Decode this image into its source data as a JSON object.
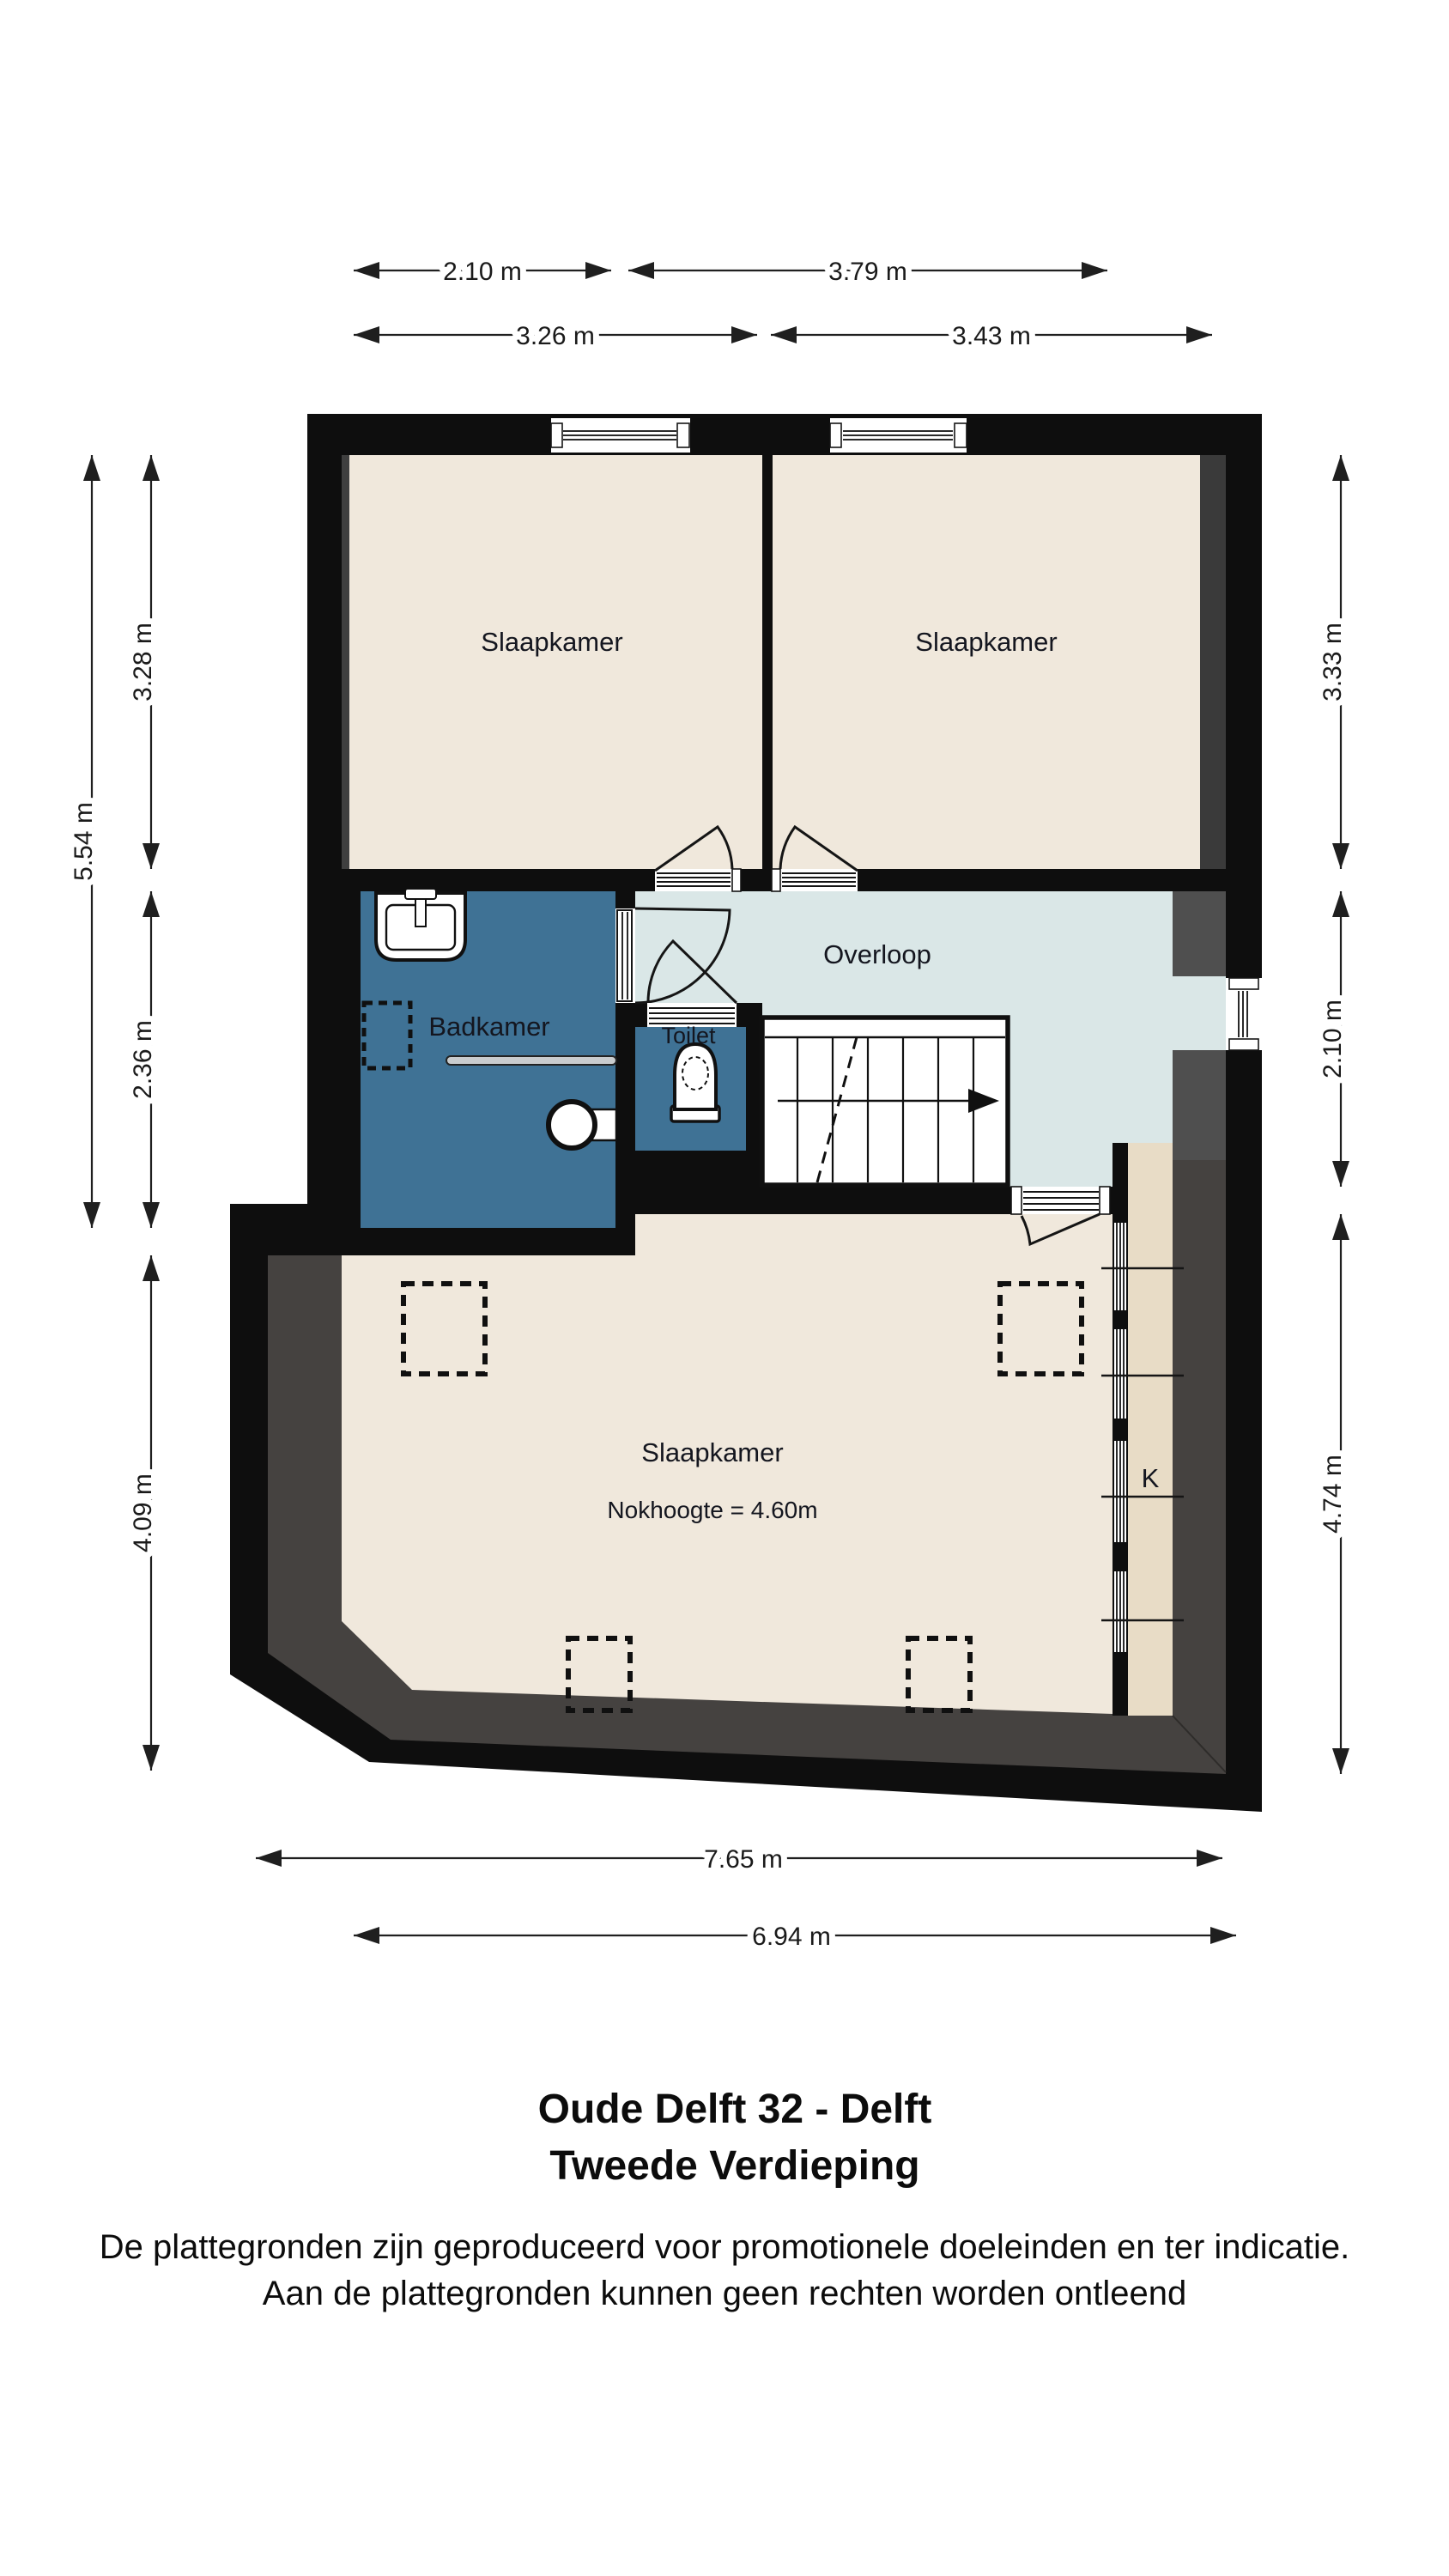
{
  "meta": {
    "document_type": "floor-plan",
    "language": "nl"
  },
  "rooms": {
    "bedroom_top_left": "Slaapkamer",
    "bedroom_top_right": "Slaapkamer",
    "landing": "Overloop",
    "bathroom": "Badkamer",
    "toilet": "Toilet",
    "attic_bedroom": "Slaapkamer",
    "attic_bedroom_note": "Nokhoogte = 4.60m",
    "closet": "K"
  },
  "dims": {
    "top_row1_left": "2.10 m",
    "top_row1_right": "3.79 m",
    "top_row2_left": "3.26 m",
    "top_row2_right": "3.43 m",
    "left_total": "5.54 m",
    "left_upper": "3.28 m",
    "left_middle": "2.36 m",
    "left_lower": "4.09 m",
    "right_upper": "3.33 m",
    "right_middle": "2.10 m",
    "right_lower": "4.74 m",
    "bottom_outer": "7.65 m",
    "bottom_inner": "6.94 m"
  },
  "footer": {
    "title_line1": "Oude Delft 32 - Delft",
    "title_line2": "Tweede Verdieping",
    "disclaimer_line1": "De plattegronden zijn geproduceerd voor promotionele doeleinden en ter indicatie.",
    "disclaimer_line2": "Aan de plattegronden kunnen geen rechten worden ontleend"
  },
  "colors": {
    "wall": "#0e0e0e",
    "floor_beige": "#f0e8dc",
    "bathroom_blue": "#3f7295",
    "landing_blue": "#dae7e7",
    "closet_tan": "#e8dcc6",
    "slope_gray": "#454240",
    "masonry_gray": "#4f4f4f"
  }
}
